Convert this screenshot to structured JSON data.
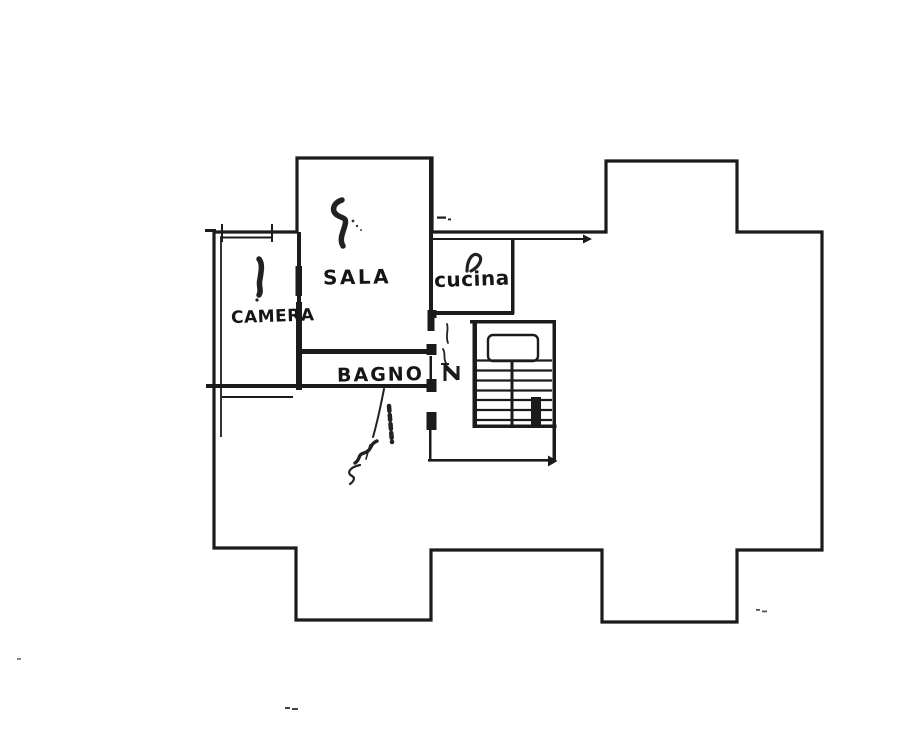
{
  "page": {
    "kind": "scanned hand-drawn floor plan",
    "paper_color": "#ffffff",
    "ink_color": "#1b1b1b"
  },
  "rooms": {
    "camera": {
      "label": "CAMERA"
    },
    "sala": {
      "label": "SALA"
    },
    "cucina": {
      "label": "CUCINA"
    },
    "bagno": {
      "label": "BAGNO"
    }
  },
  "staircase": {
    "tread_rows": 7
  }
}
